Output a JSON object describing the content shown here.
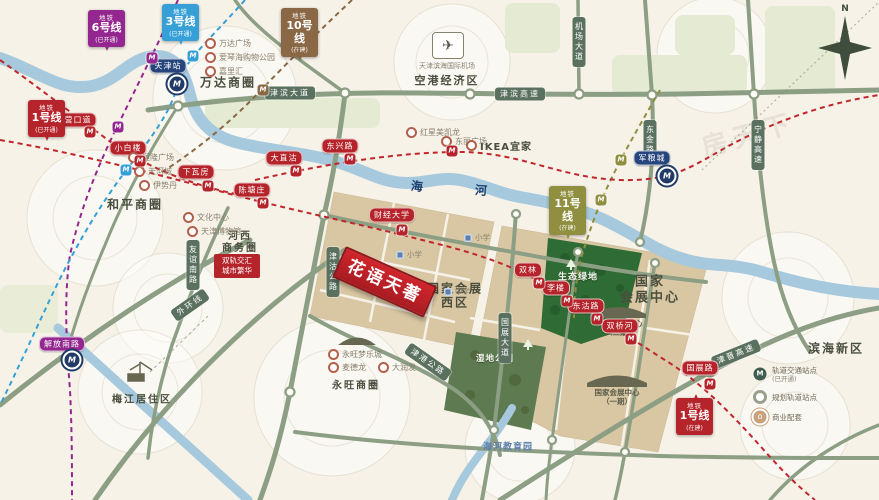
{
  "watermark": "房天下",
  "compass": {
    "north": "N"
  },
  "project": {
    "name": "花语天著",
    "callout": [
      "双轨交汇",
      "城市繁华"
    ]
  },
  "river": {
    "label": [
      "海",
      "河"
    ]
  },
  "districts": {
    "wanda": "万达商圈",
    "heping": "和平商圈",
    "hexi": [
      "河西",
      "商务圈"
    ],
    "meijiang": "梅江居住区",
    "yongwang": "永旺商圈",
    "binhai": "滨海新区",
    "konggang": "空港经济区",
    "airport": "天津滨海国际机场",
    "haihe_edu": "海河教育园",
    "expo_west": [
      "国家会展",
      "西区"
    ],
    "expo_center": [
      "国家",
      "会展中心"
    ],
    "expo_p1": [
      "国家会展中心",
      "（一期）"
    ],
    "expo_p2": [
      "国家会展中心",
      "（二期）"
    ],
    "eco": "生态绿地",
    "wetland": "湿地公园"
  },
  "pois": {
    "wanda": [
      "万达广场",
      "爱琴海购物公园",
      "嘉里汇"
    ],
    "heping": [
      "恒隆广场",
      "天河城",
      "伊势丹"
    ],
    "hexi": [
      "文化中心",
      "天津博物馆"
    ],
    "dongli": [
      "红星美凯龙",
      "东丽广场"
    ],
    "ikea": "IKEA宜家",
    "yongwang": [
      "永旺梦乐城",
      "麦德龙",
      "大润发"
    ],
    "schools": [
      "小学",
      "小学",
      "中学"
    ]
  },
  "roads": {
    "jinbin_av": "津滨大道",
    "jinbin_hwy": "津滨高速",
    "airport_rd": "机场大道",
    "dongjin": "东金路",
    "ningjing": "宁静高速",
    "jingu": "津沽公路",
    "youyi": "友谊南路",
    "guozhan_av": "国展大道",
    "outer_ring": "外环线",
    "jingang": "津港公路",
    "jinjin": "津晋高速"
  },
  "metro_badges": [
    {
      "prefix": "地铁",
      "line": "6号线",
      "status": "(已开通)",
      "color": "#93268f"
    },
    {
      "prefix": "地铁",
      "line": "3号线",
      "status": "(已开通)",
      "color": "#36a0d6"
    },
    {
      "prefix": "地铁",
      "line": "10号线",
      "status": "(在建)",
      "color": "#8a6845"
    },
    {
      "prefix": "地铁",
      "line": "11号线",
      "status": "(在建)",
      "color": "#8f8f3f"
    },
    {
      "prefix": "地铁",
      "line": "1号线",
      "status": "(已开通)",
      "color": "#b6242b"
    },
    {
      "prefix": "地铁",
      "line": "1号线",
      "status": "(在建)",
      "color": "#b6242b"
    }
  ],
  "stations": {
    "red": [
      "营口道",
      "小白楼",
      "下瓦房",
      "陈塘庄",
      "大直沽",
      "东兴路",
      "财经大学",
      "双林",
      "李楼",
      "东沽路",
      "双桥河",
      "国展路"
    ],
    "blue": [
      "天津站",
      "军粮城"
    ],
    "purple": [
      "解放南路"
    ]
  },
  "legend": {
    "items": [
      {
        "label": "轨道交通站点",
        "sub": "(已开通)"
      },
      {
        "label": "规划轨道站点",
        "sub": ""
      },
      {
        "label": "商业配套",
        "sub": ""
      }
    ]
  }
}
